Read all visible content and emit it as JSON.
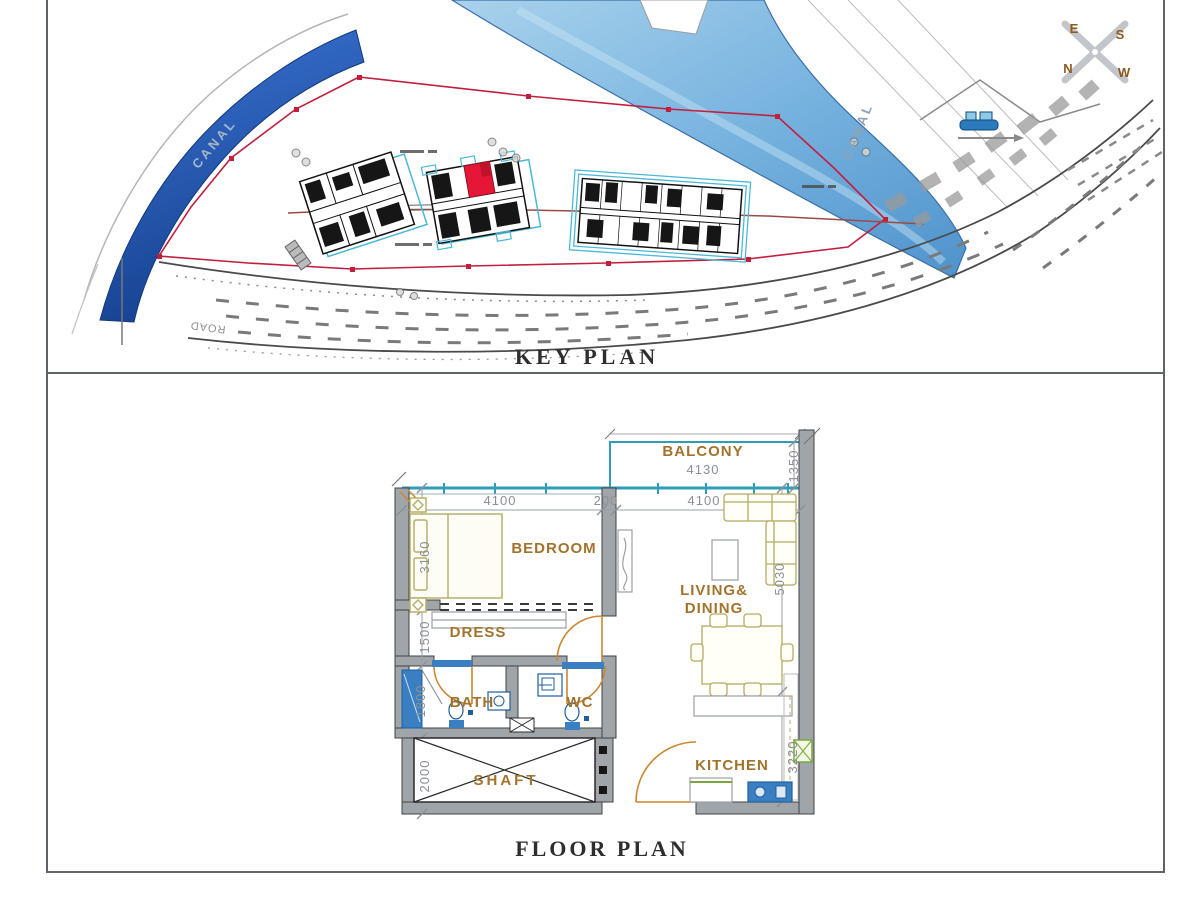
{
  "page": {
    "key_plan_title": "KEY PLAN",
    "floor_plan_title": "FLOOR PLAN"
  },
  "key_plan": {
    "canal_label_left": "CANAL",
    "canal_label_right": "CANAL",
    "road_label": "ROAD",
    "compass": {
      "e": "E",
      "s": "S",
      "n": "N",
      "w": "W"
    }
  },
  "floor_plan": {
    "rooms": {
      "balcony": "BALCONY",
      "bedroom": "BEDROOM",
      "dress": "DRESS",
      "bath": "BATH",
      "wc": "WC",
      "shaft": "SHAFT",
      "living_line1": "LIVING&",
      "living_line2": "DINING",
      "kitchen": "KITCHEN"
    },
    "dims": {
      "balcony_width": "4130",
      "balcony_depth": "1350",
      "bedroom_width": "4100",
      "partition": "200",
      "living_width": "4100",
      "bedroom_depth": "3160",
      "dress_depth": "1500",
      "bath_depth": "1800",
      "shaft_depth": "2000",
      "living_depth": "5030",
      "kitchen_depth": "3220"
    }
  },
  "colors": {
    "water_blue": "#2e63c6",
    "canal_blue": "#5b9bd5",
    "boundary_red": "#c21f3f",
    "highlight_unit_red": "#e51636",
    "building_cyan": "#49b8d8",
    "window_teal": "#2f9db8",
    "room_label_brown": "#a2732c",
    "door_orange": "#cc862f",
    "wall_gray": "#a0a5a9",
    "dim_gray": "#8b9096",
    "compass_brown": "#8a5a1e"
  }
}
